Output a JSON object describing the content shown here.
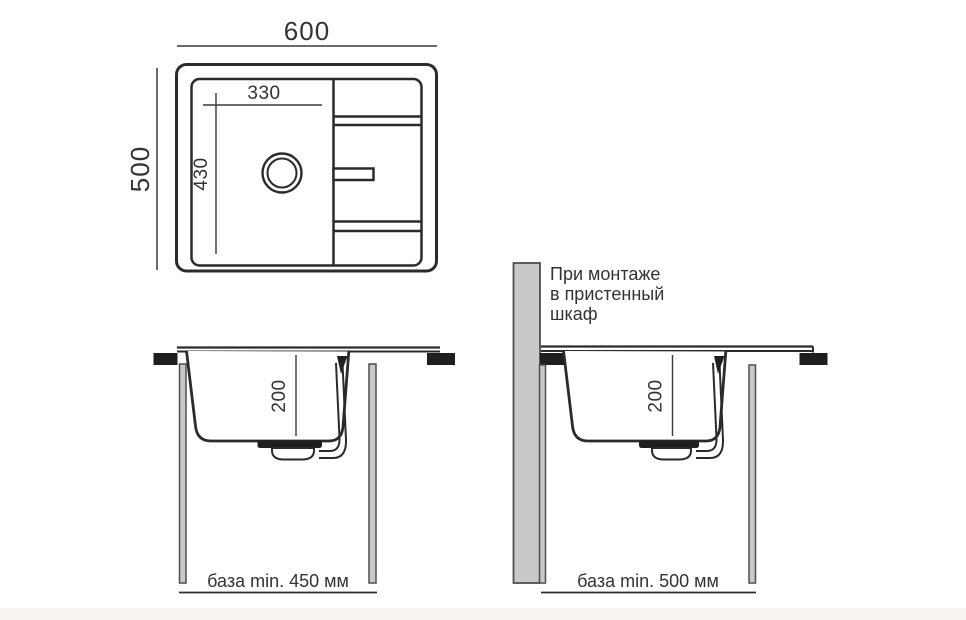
{
  "top_view": {
    "overall_width": "600",
    "overall_depth": "500",
    "bowl_width": "330",
    "bowl_length": "430"
  },
  "section_front": {
    "bowl_depth": "200",
    "base_label": "база min. 450 мм"
  },
  "section_wall": {
    "bowl_depth": "200",
    "note_line1": "При монтаже",
    "note_line2": "в пристенный",
    "note_line3": "шкаф",
    "base_label": "база min. 500 мм"
  },
  "colors": {
    "line": "#2b2b2b",
    "dimension": "#3a3a3a",
    "panel_fill": "#c9c9c9",
    "panel_stroke": "#4f4f4f",
    "clamp": "#1f1f1f"
  }
}
